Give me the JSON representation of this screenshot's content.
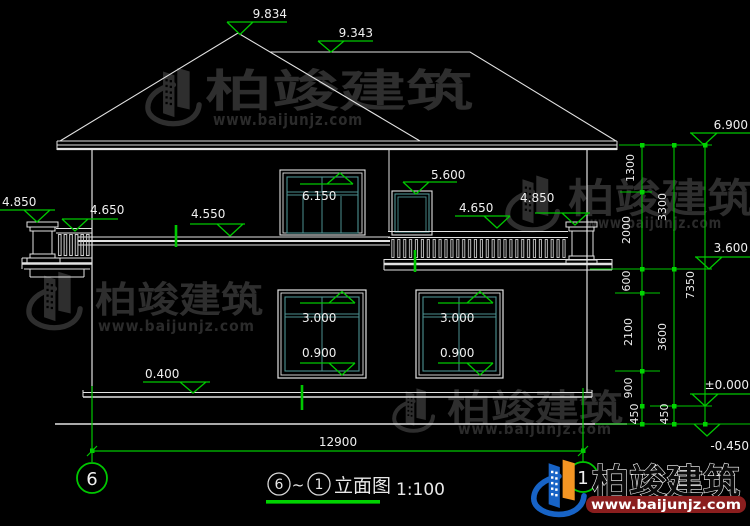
{
  "drawing": {
    "title_grid_start": "6",
    "title_tilde": "~",
    "title_grid_end": "1",
    "title_caption": "立面图",
    "scale": "1:100",
    "grid_bubble_left": "6",
    "grid_bubble_right": "1"
  },
  "levels": {
    "roof_peak": "9.834",
    "roof_ridge": "9.343",
    "eaves": "6.900",
    "balcony_door_top": "6.150",
    "upper_window_top": "5.600",
    "left_post_cap": "4.850",
    "left_rail": "4.650",
    "floor_slab": "4.550",
    "right_rail": "4.650",
    "right_post_cap": "4.850",
    "rail_bottom": "3.600",
    "window_head": "3.000",
    "window_sill": "0.900",
    "plinth_top": "0.400",
    "ground_floor": "±0.000",
    "site_grade": "-0.450"
  },
  "dimensions": {
    "total_width": "12900",
    "total_height": "7350",
    "right_chain_segments": [
      "1300",
      "2000",
      "600",
      "2100",
      "900",
      "450"
    ],
    "middle_chain_segments": [
      "3300",
      "3600",
      "450"
    ]
  },
  "watermark": {
    "brand": "柏竣建筑",
    "url": "www.baijunjz.com"
  },
  "footer_logo": {
    "brand": "柏竣建筑",
    "url": "www.baijunjz.com"
  },
  "colors": {
    "background": "#000000",
    "line": "#e2e2e2",
    "dimension_green": "#00c800",
    "glass_teal": "#4d9191",
    "watermark_gray": "#2e2e2e",
    "logo_blue": "#1763c6",
    "logo_orange": "#f49523",
    "url_bar_red": "#8a1e1e"
  }
}
